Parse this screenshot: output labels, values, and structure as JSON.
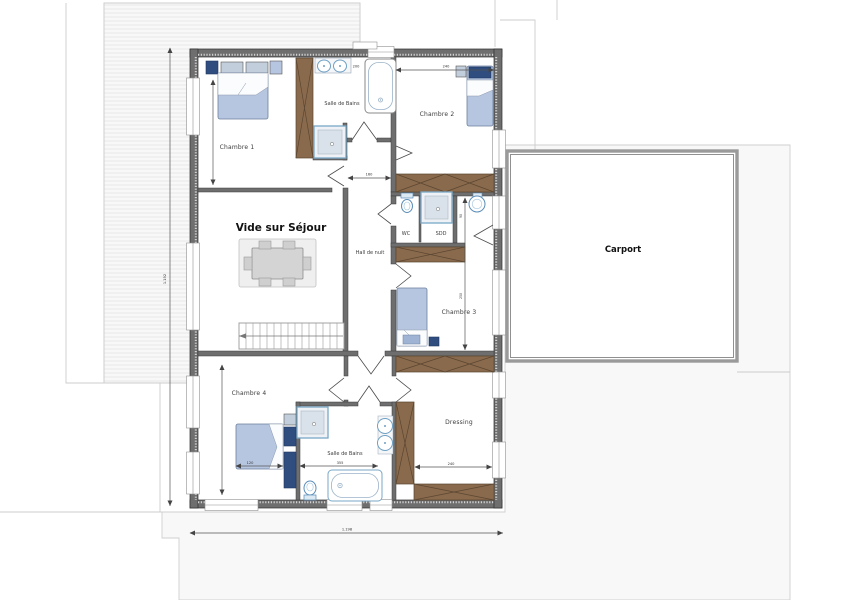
{
  "rooms": {
    "chambre1": "Chambre 1",
    "chambre2": "Chambre 2",
    "chambre3": "Chambre 3",
    "chambre4": "Chambre 4",
    "bathroom_top": "Salle de Bains",
    "bathroom_bottom": "Salle de Bains",
    "wc": "WC",
    "sdd": "SDD",
    "hall": "Hall de nuit",
    "void": "Vide sur Séjour",
    "dressing": "Dressing",
    "carport": "Carport"
  },
  "dimensions": {
    "overall_width": "1.198",
    "overall_height": "1.192",
    "chambre2_top": "240",
    "sinks_top": "200",
    "hall_width": "160",
    "bathroom_bottom_width": "355",
    "chambre4_bed": "120",
    "dressing_width": "240",
    "nook_height": "90",
    "chambre3_height": "250"
  },
  "colors": {
    "wall": "#6e6e6e",
    "wall_edge": "#2e2e2e",
    "wood": "#8a6a4c",
    "wood_dark": "#5a4632",
    "furniture_blue": "#b7c6e0",
    "furniture_navy": "#2f4d7e",
    "fixture_blue": "#7aa7c7",
    "carport_border": "#9a9a9a",
    "faint_line": "#c9c9c9",
    "dim_line": "#555555"
  }
}
